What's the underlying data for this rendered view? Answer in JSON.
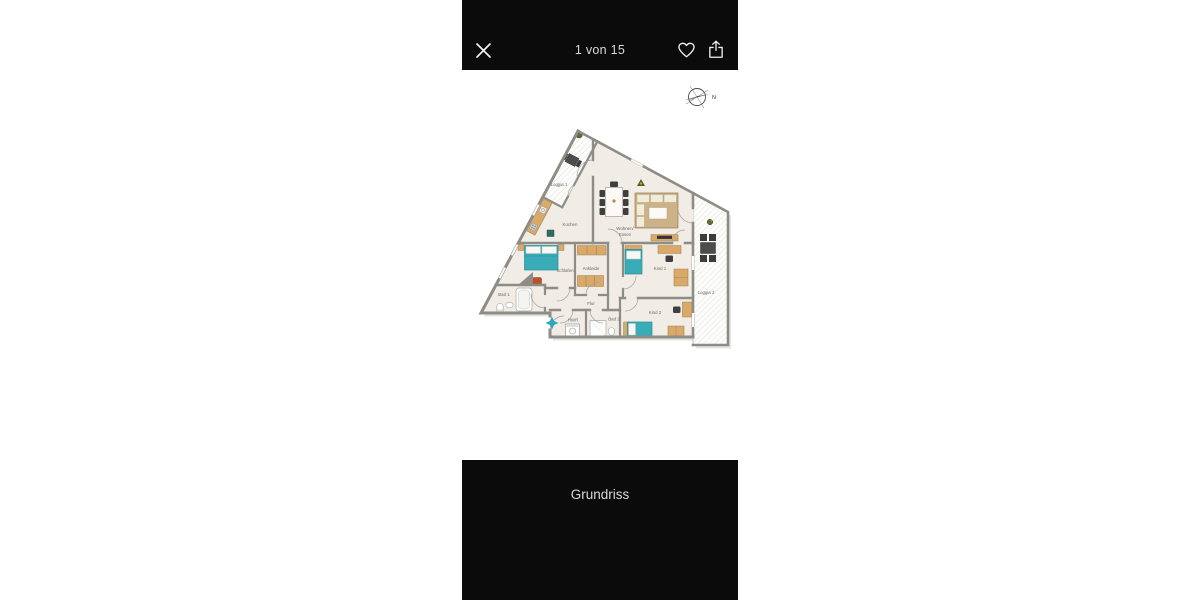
{
  "viewer": {
    "counter": "1 von 15",
    "caption": "Grundriss",
    "icons": {
      "close": "x-cross",
      "favorite": "heart-outline",
      "share": "box-arrow-up"
    }
  },
  "floorplan": {
    "compass_label": "N",
    "rooms": {
      "loggia1": "Loggia 1",
      "kochen": "Kochen",
      "wohnen_line1": "Wohnen/",
      "wohnen_line2": "Essen",
      "schlafen": "Schlafen",
      "ankleide": "Ankleide",
      "bad1": "Bad 1",
      "flur": "Flur",
      "hwr": "HWR",
      "bad2": "Bad 2",
      "kind1": "Kind 1",
      "kind2": "Kind 2",
      "loggia2": "Loggia 2"
    },
    "colors": {
      "floor": "#f1ece5",
      "wall": "#8d8d85",
      "furniture_wood": "#d9a96a",
      "sofa": "#cbb289",
      "bed_teal": "#3aacb8",
      "dark_furniture": "#3f3f3f",
      "entrance_marker": "#2aa7c0"
    }
  },
  "chrome": {
    "bar_color": "#0b0b0b",
    "bar_text_color": "#d9d9d9",
    "background": "#ffffff"
  }
}
